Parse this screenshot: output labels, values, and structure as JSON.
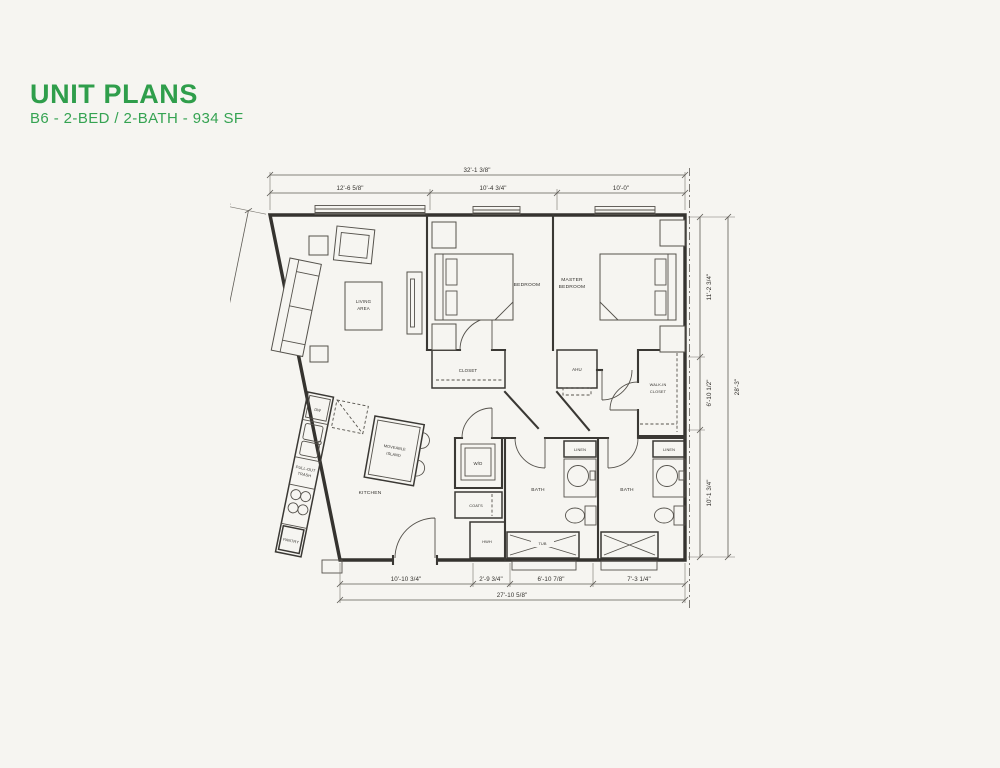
{
  "page": {
    "title": "UNIT PLANS",
    "subtitle": "B6 - 2-BED / 2-BATH - 934 SF",
    "accent_color": "#2f9e4b",
    "paper_color": "#f6f5f1",
    "ink_color": "#35332f"
  },
  "floorplan": {
    "rooms": {
      "living_area": [
        "LIVING",
        "AREA"
      ],
      "kitchen": "KITCHEN",
      "bedroom": "BEDROOM",
      "master_bedroom": [
        "MASTER",
        "BEDROOM"
      ],
      "closet": "CLOSET",
      "walk_in_closet": [
        "WALK-IN",
        "CLOSET"
      ],
      "bath_1": "BATH",
      "bath_2": "BATH"
    },
    "fixtures": {
      "ahu": "AHU",
      "washer_dryer": "W/D",
      "coats": "COATS",
      "water_heater": "HWH",
      "tub": "TUB",
      "linen_1": "LINEN",
      "linen_2": "LINEN",
      "dishwasher": "DW",
      "pull_out_trash": [
        "PULL-OUT",
        "TRASH"
      ],
      "pantry": "PANTRY",
      "moveable_island": [
        "MOVEABLE",
        "ISLAND"
      ]
    },
    "dimensions": {
      "top_overall": "32'-1 3/8\"",
      "top_segments": [
        "12'-6 5/8\"",
        "10'-4 3/4\"",
        "10'-0\""
      ],
      "right_overall": "28'-3\"",
      "right_segments": [
        "11'-2 3/4\"",
        "6'-10 1/2\"",
        "10'-1 3/4\""
      ],
      "bottom_overall": "27'-10 5/8\"",
      "bottom_segments": [
        "10'-10 3/4\"",
        "2'-9 3/4\"",
        "6'-10 7/8\"",
        "7'-3 1/4\""
      ],
      "left_overall": "28'-8 1/8\"",
      "left_segments": [
        "14'-8 1/4\"",
        "13'-11 7/8\""
      ]
    }
  }
}
